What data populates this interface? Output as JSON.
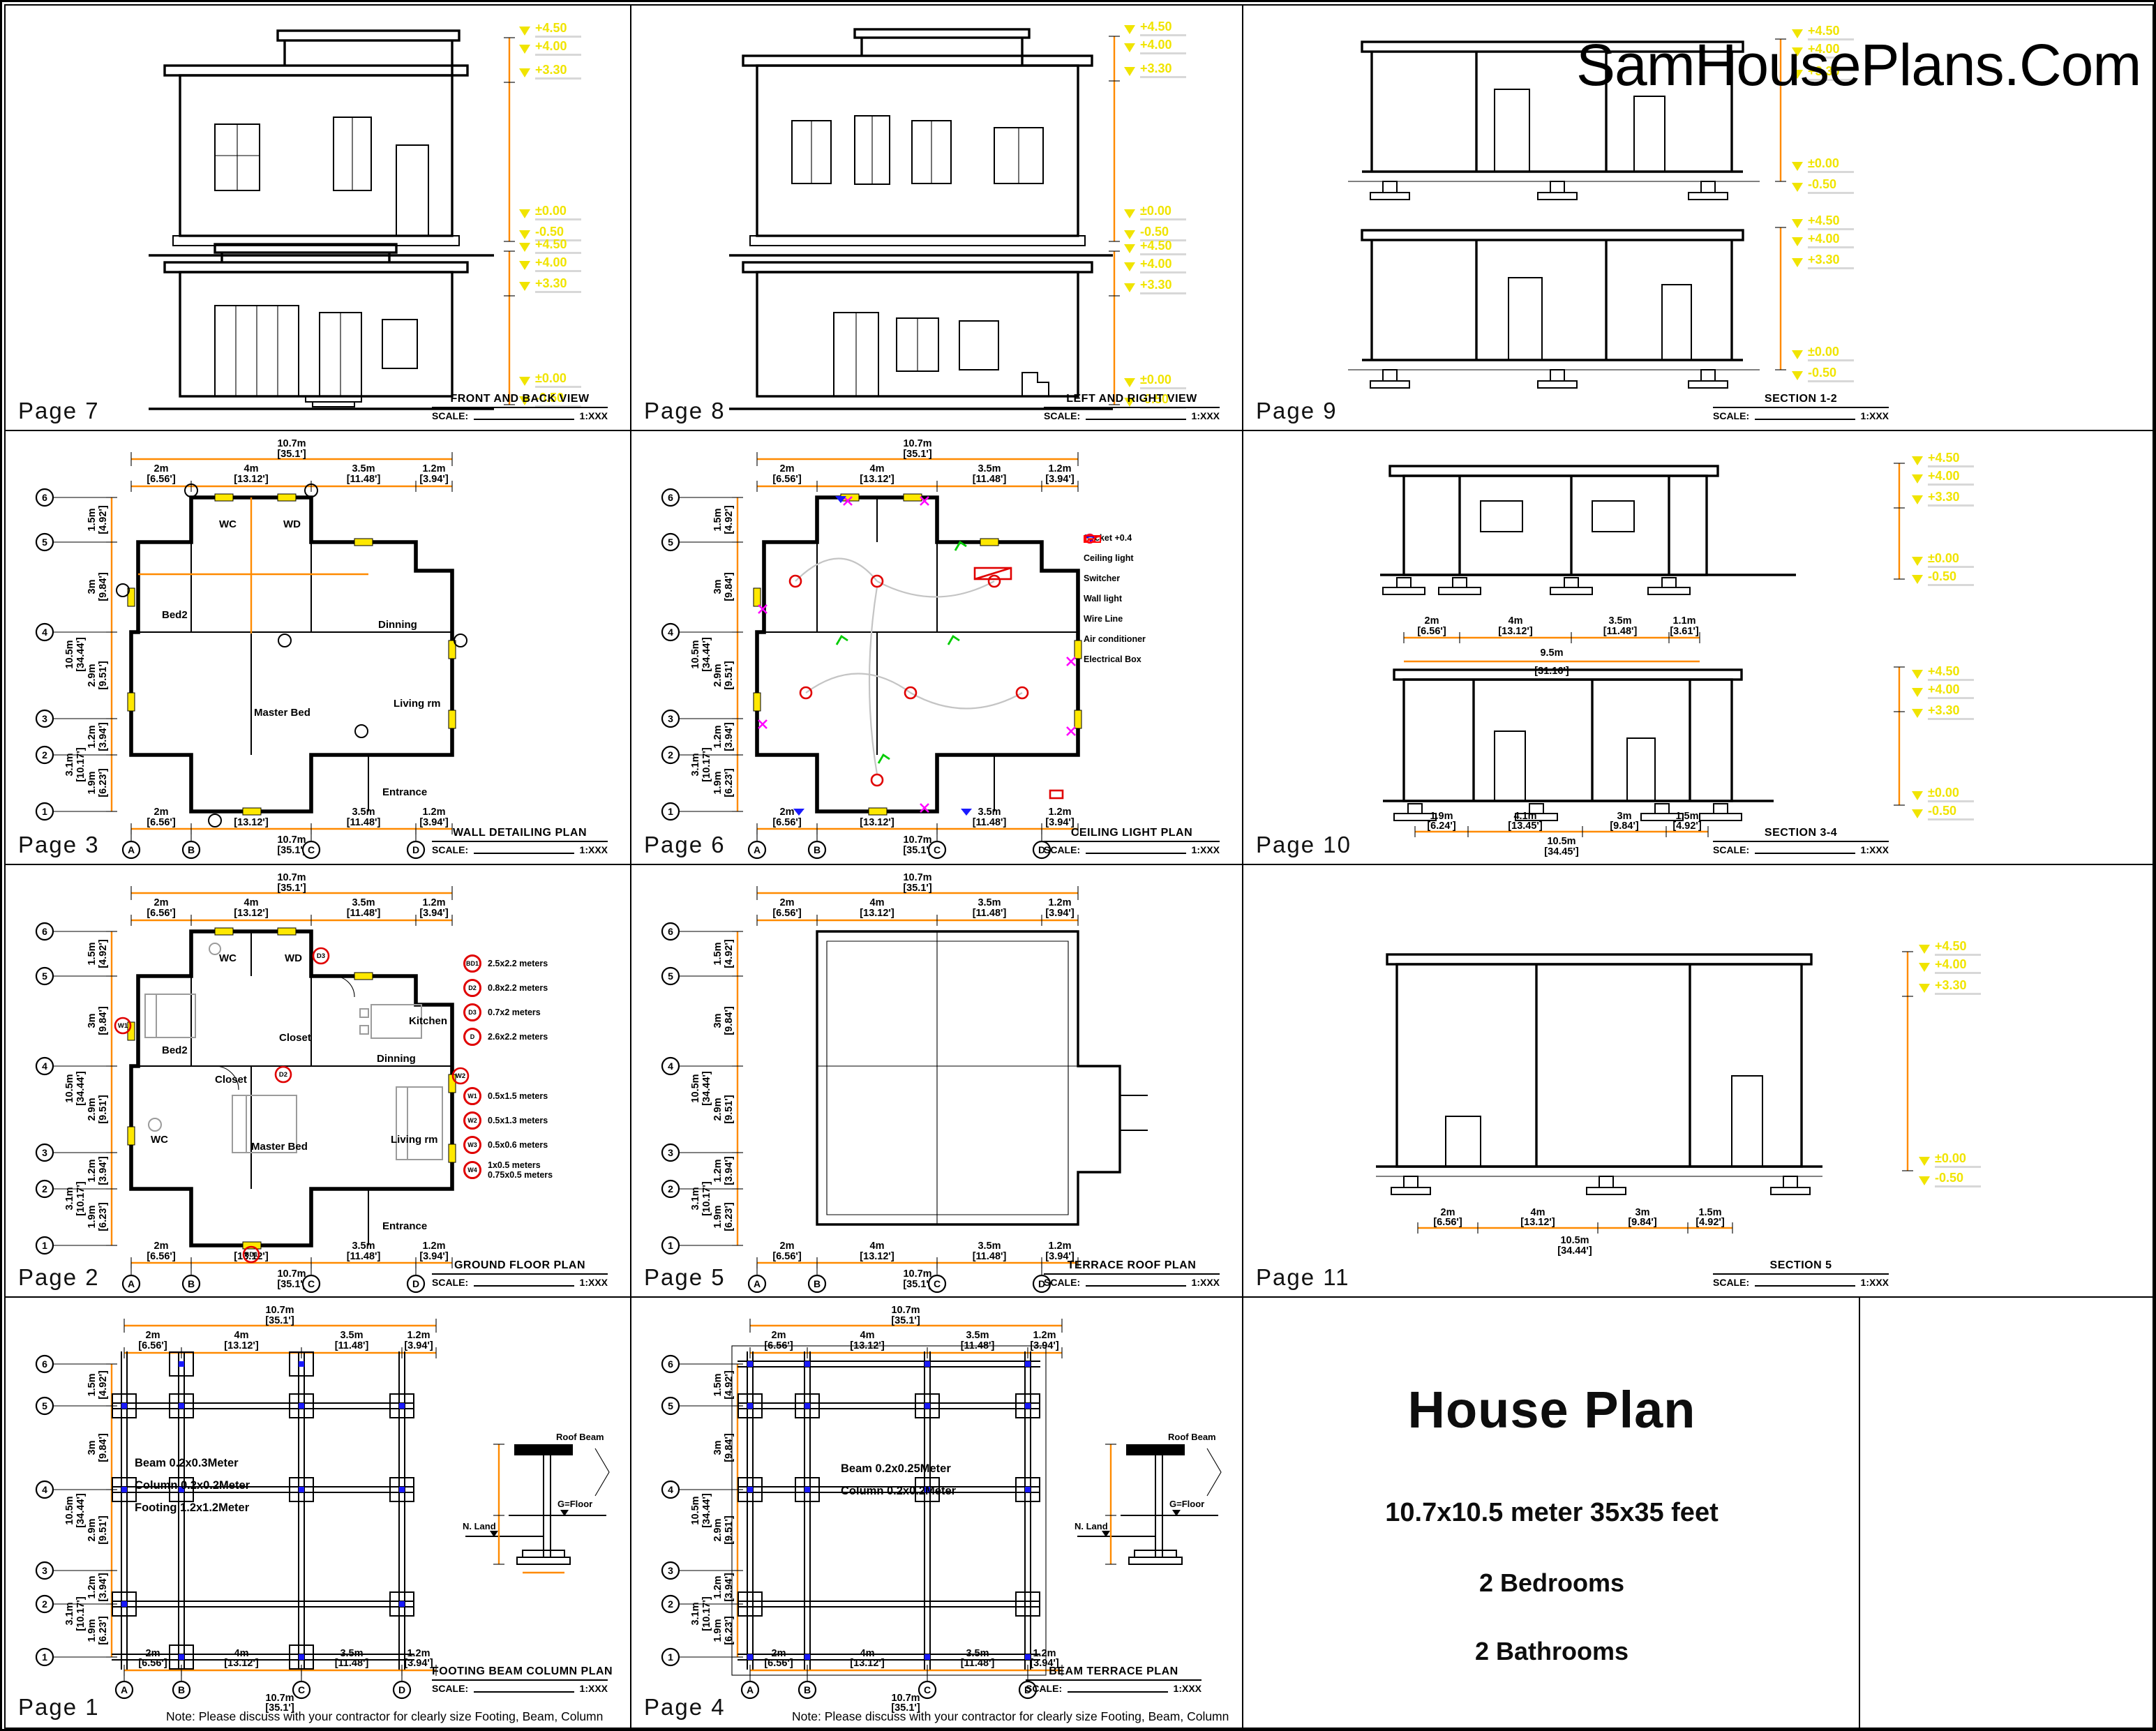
{
  "watermark": "SamHousePlans.Com",
  "scale": {
    "label": "SCALE:",
    "value": "1:XXX"
  },
  "axes": {
    "rows": [
      "6",
      "5",
      "4",
      "3",
      "2",
      "1"
    ],
    "cols": [
      "A",
      "B",
      "C",
      "D"
    ]
  },
  "elev": [
    "+4.50",
    "+4.00",
    "+3.30",
    "±0.00",
    "-0.50"
  ],
  "dim_top": {
    "om": "10.7m",
    "oft": "[35.1']",
    "m": [
      "2m",
      "4m",
      "3.5m",
      "1.2m"
    ],
    "ft": [
      "[6.56']",
      "[13.12']",
      "[11.48']",
      "[3.94']"
    ]
  },
  "dim_left": {
    "om": "10.5m",
    "oft": "[34.44']",
    "m": [
      "1.5m",
      "3m",
      "2.9m",
      "1.2m",
      "1.9m"
    ],
    "ft": [
      "[4.92']",
      "[9.84']",
      "[9.51']",
      "[3.94']",
      "[6.23']"
    ],
    "sub_m": "3.1m",
    "sub_ft": "[10.17']"
  },
  "dim_s34a": {
    "om": "9.5m",
    "oft": "[31.16']",
    "m": [
      "2m",
      "4m",
      "3.5m",
      "1.1m"
    ],
    "ft": [
      "[6.56']",
      "[13.12']",
      "[11.48']",
      "[3.61']"
    ]
  },
  "dim_s34b": {
    "om": "10.5m",
    "oft": "[34.45']",
    "m": [
      "1.9m",
      "4.1m",
      "3m",
      "1.5m"
    ],
    "ft": [
      "[6.24']",
      "[13.45']",
      "[9.84']",
      "[4.92']"
    ]
  },
  "dim_s5": {
    "om": "10.5m",
    "oft": "[34.44']",
    "m": [
      "2m",
      "4m",
      "3m",
      "1.5m"
    ],
    "ft": [
      "[6.56']",
      "[13.12']",
      "[9.84']",
      "[4.92']"
    ]
  },
  "pages": {
    "p7": {
      "label": "Page 7",
      "title": "FRONT AND BACK VIEW"
    },
    "p8": {
      "label": "Page 8",
      "title": "LEFT AND RIGHT VIEW"
    },
    "p9": {
      "label": "Page 9",
      "title": "SECTION 1-2"
    },
    "p3": {
      "label": "Page 3",
      "title": "WALL DETAILING PLAN"
    },
    "p6": {
      "label": "Page 6",
      "title": "CEILING LIGHT PLAN"
    },
    "p10": {
      "label": "Page 10",
      "title": "SECTION 3-4"
    },
    "p2": {
      "label": "Page 2",
      "title": "GROUND FLOOR PLAN"
    },
    "p5": {
      "label": "Page 5",
      "title": "TERRACE ROOF PLAN"
    },
    "p11": {
      "label": "Page 11",
      "title": "SECTION 5"
    },
    "p1": {
      "label": "Page 1",
      "title": "FOOTING BEAM COLUMN PLAN",
      "note": "Note: Please discuss with your contractor for clearly size Footing, Beam, Column",
      "spec": [
        "Beam  0.2x0.3Meter",
        "Column  0.2x0.2Meter",
        "Footing  1.2x1.2Meter"
      ]
    },
    "p4": {
      "label": "Page 4",
      "title": "BEAM TERRACE PLAN",
      "note": "Note: Please discuss with your contractor for clearly size Footing, Beam, Column",
      "spec": [
        "Beam  0.2x0.25Meter",
        "Column  0.2x0.2Meter"
      ]
    }
  },
  "rooms": {
    "bed2": "Bed2",
    "wc": "WC",
    "wd": "WD",
    "kitchen": "Kitchen",
    "dinning": "Dinning",
    "closet": "Closet",
    "living": "Living rm",
    "master": "Master Bed",
    "entrance": "Entrance"
  },
  "ceiling_legend": [
    {
      "label": "Socket +0.4",
      "color": "#ff00ff"
    },
    {
      "label": "Ceiling light",
      "color": "#ff0033"
    },
    {
      "label": "Switcher",
      "color": "#00cc00"
    },
    {
      "label": "Wall light",
      "color": "#0000ff"
    },
    {
      "label": "Wire Line",
      "color": "#c4c4c4"
    },
    {
      "label": "Air conditioner",
      "color": "#ff0000"
    },
    {
      "label": "Electrical Box",
      "color": "#ff0000"
    }
  ],
  "dw_legend": {
    "doors": [
      {
        "tag": "BD1",
        "size": "2.5x2.2 meters"
      },
      {
        "tag": "D2",
        "size": "0.8x2.2 meters"
      },
      {
        "tag": "D3",
        "size": "0.7x2 meters"
      },
      {
        "tag": "D",
        "size": "2.6x2.2 meters"
      }
    ],
    "windows": [
      {
        "tag": "W1",
        "size": "0.5x1.5 meters"
      },
      {
        "tag": "W2",
        "size": "0.5x1.3 meters"
      },
      {
        "tag": "W3",
        "size": "0.5x0.6 meters"
      },
      {
        "tag": "W4",
        "size": "1x0.5 meters",
        "size2": "0.75x0.5 meters"
      }
    ]
  },
  "detail": {
    "roof_beam": "Roof Beam",
    "g_floor": "G=Floor",
    "n_land": "N. Land"
  },
  "title_block": {
    "title": "House Plan",
    "size": "10.7x10.5 meter 35x35 feet",
    "bedrooms": "2 Bedrooms",
    "bathrooms": "2 Bathrooms"
  },
  "colors": {
    "dimension": "#ff8a00",
    "elevation_text": "#f0e400",
    "window_marker": "#ffe800",
    "column_marker": "#1a1aff",
    "tag_red": "#e00000"
  }
}
